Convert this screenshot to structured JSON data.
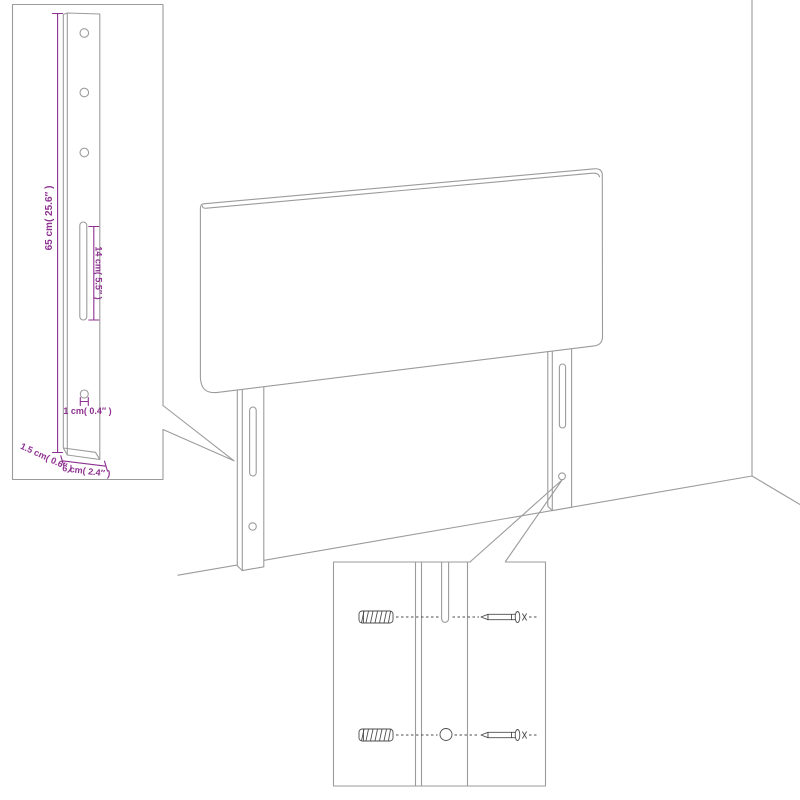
{
  "drawing": {
    "type": "furniture-assembly-diagram",
    "subject": "upholstered headboard with two mounting legs, wall corner, leg detail inset and screw/anchor mounting inset",
    "colors": {
      "dimension": "#8e3191",
      "outline": "#9b9b9b",
      "hardware": "#4d4d4d",
      "background": "#ffffff"
    },
    "inset_leg": {
      "dim_height": "65 cm( 25.6″ )",
      "dim_slot": "14 cm( 5.5″ )",
      "dim_hole": "1 cm( 0.4″ )",
      "dim_thickness": "1.5 cm( 0.6″ )",
      "dim_width": "6 cm( 2.4″ )",
      "top_holes": 3,
      "bottom_holes": 1,
      "slots": 1
    },
    "main_view": {
      "legs": 2,
      "slots_per_leg": 1,
      "holes_per_leg": 1
    },
    "detail_view": {
      "rows": 2,
      "wall_anchors": 2,
      "screws": 2
    }
  }
}
